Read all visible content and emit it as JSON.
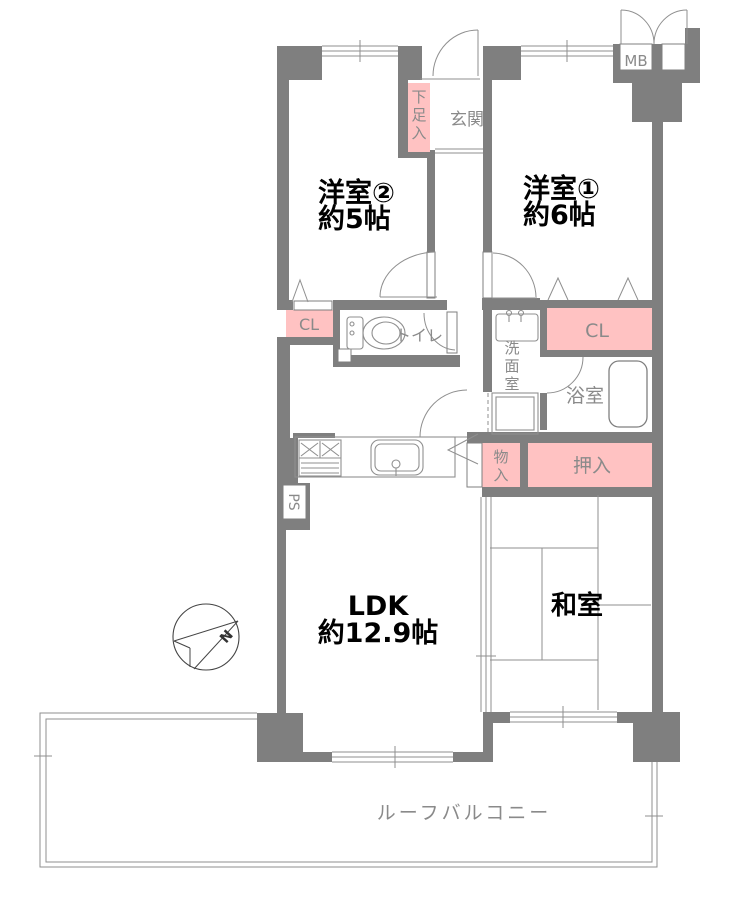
{
  "plan": {
    "bedroom2": {
      "name": "洋室②",
      "size": "約5帖"
    },
    "bedroom1": {
      "name": "洋室①",
      "size": "約6帖"
    },
    "entrance": "玄関",
    "shoe_box": "下足入",
    "meter_box": "MB",
    "closet_left": "CL",
    "closet_right": "CL",
    "toilet": "トイレ",
    "washroom": "洗面室",
    "bathroom": "浴室",
    "storage_small": "物入",
    "futon_closet": "押入",
    "ldk": {
      "name": "LDK",
      "size": "約12.9帖"
    },
    "japanese_room": "和室",
    "pipe_space": "PS",
    "roof_balcony": "ルーフバルコニー",
    "compass_north": "N"
  },
  "colors": {
    "wall": "#7f7f7f",
    "closet_fill": "#ffc2c2",
    "gray_label": "#8a8a8a",
    "black_label": "#000000"
  }
}
